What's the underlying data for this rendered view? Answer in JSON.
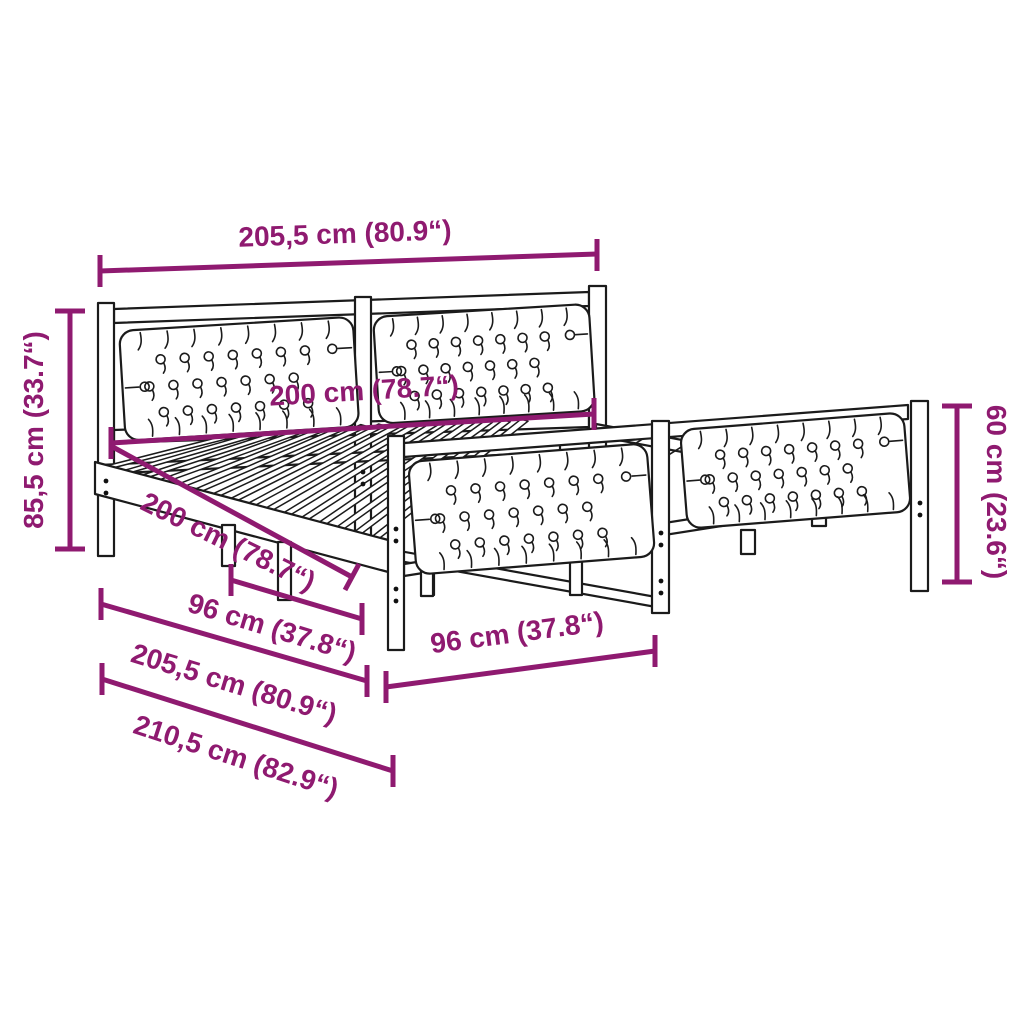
{
  "illustration": {
    "subject": "bed-frame-with-two-tufted-headboards-dimension-diagram"
  },
  "colors": {
    "dimension_color": "#8F1A70",
    "line_art_color": "#1b1b1b",
    "background": "#ffffff"
  },
  "dimensions": {
    "top_width": "205,5 cm (80.9“)",
    "headboard_height": "85,5 cm (33.7“)",
    "inner_width": "200 cm (78.7“)",
    "inner_length": "200 cm (78.7“)",
    "slat_left": "96 cm (37.8“)",
    "slat_right": "96 cm (37.8“)",
    "outer_width": "205,5 cm (80.9“)",
    "total_length": "210,5 cm (82.9“)",
    "footboard_height": "60 cm (23.6“)"
  }
}
